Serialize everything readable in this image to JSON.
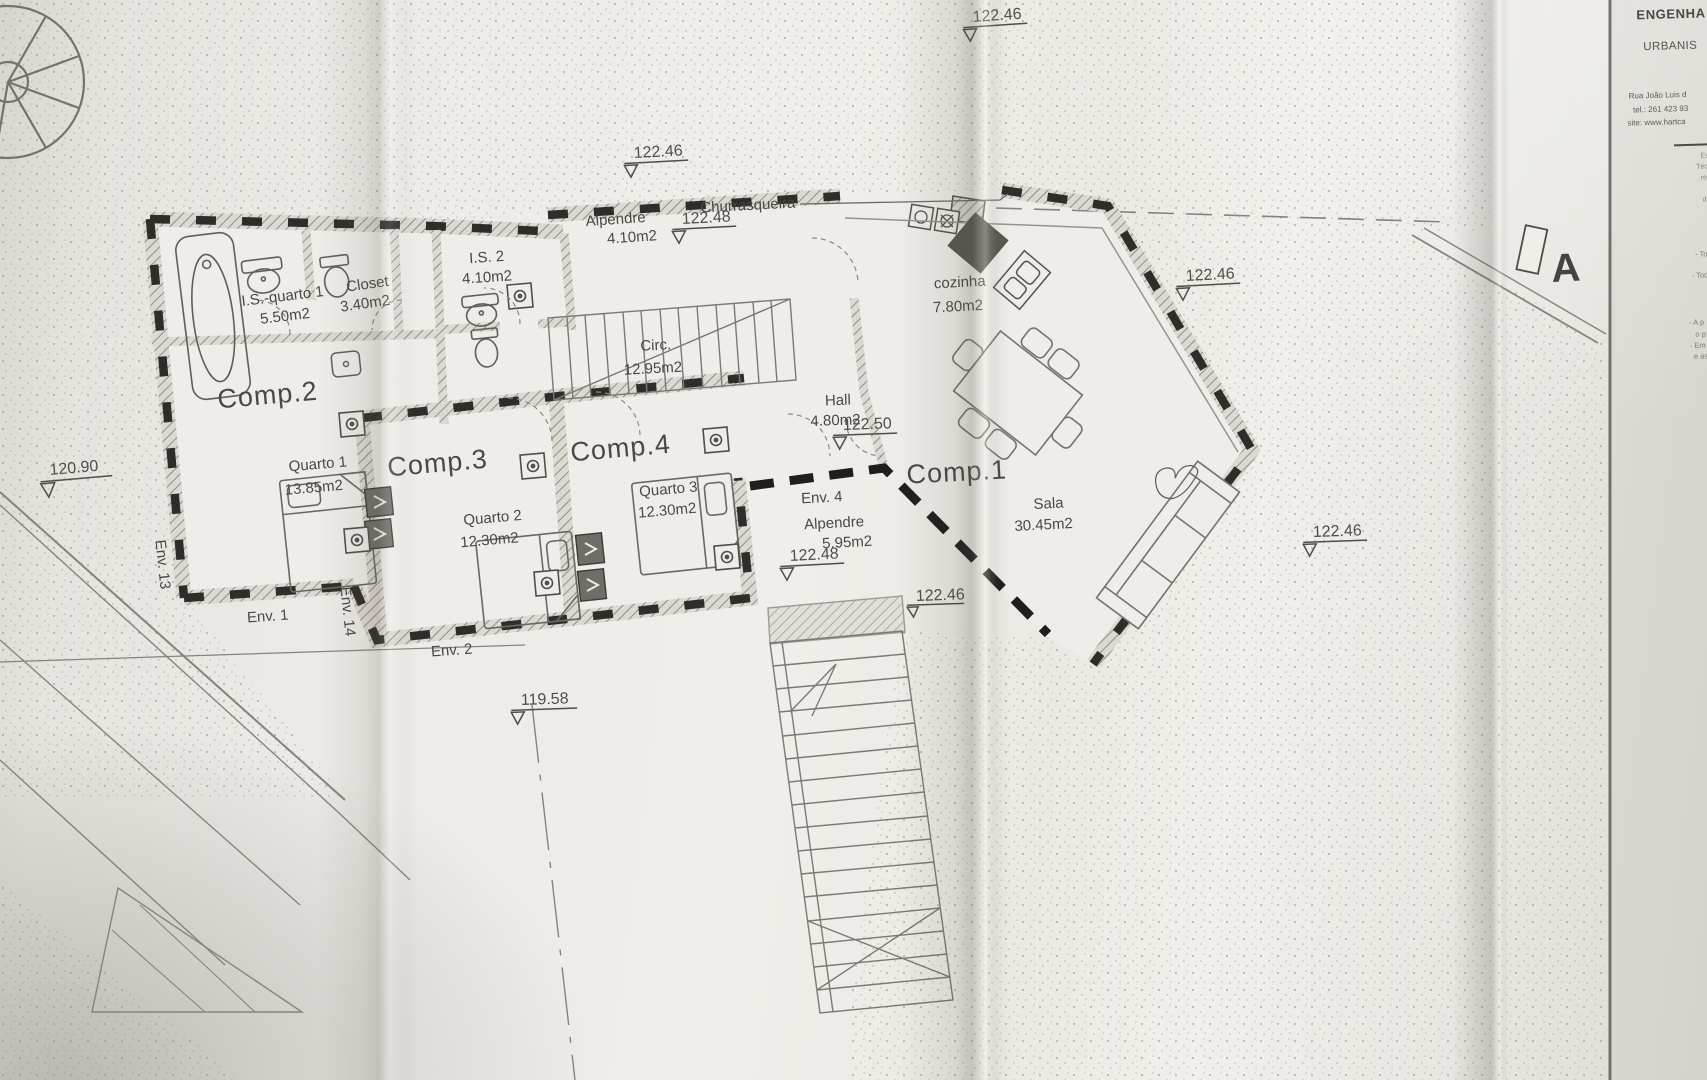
{
  "document": {
    "type": "floor-plan-photo",
    "section_marker": "A",
    "ink_color": "#45433f",
    "paper_color": "#efede9"
  },
  "title_block": {
    "heading1": "ENGENHA",
    "heading2": "URBANIS",
    "address_line": "Rua João Luis d",
    "tel_line": "tel.: 261 423 93",
    "site_line": "site: www.hartca",
    "fine_print": [
      "Este d",
      "Técnico",
      "reprod",
      "sem",
      "direito"
    ],
    "notes": [
      "- Tod",
      "- Toda",
      "- A p",
      "o p",
      "- Em",
      "e as"
    ]
  },
  "rooms": {
    "comp1": {
      "label": "Comp.1",
      "name": "Sala",
      "area": "30.45m2"
    },
    "comp2": {
      "label": "Comp.2",
      "name": "Quarto 1",
      "area": "13.85m2"
    },
    "comp3": {
      "label": "Comp.3",
      "name": "Quarto 2",
      "area": "12.30m2"
    },
    "comp4": {
      "label": "Comp.4",
      "name": "Quarto 3",
      "area": "12.30m2"
    },
    "is_quarto1": {
      "name": "I.S.-quarto 1",
      "area": "5.50m2"
    },
    "closet": {
      "name": "Closet",
      "area": "3.40m2"
    },
    "is2": {
      "name": "I.S. 2",
      "area": "4.10m2"
    },
    "alpendre_norte": {
      "name": "Alpendre",
      "area": "4.10m2"
    },
    "churrasqueira": {
      "name": "Churrasqueira"
    },
    "cozinha": {
      "name": "cozinha",
      "area": "7.80m2"
    },
    "circ": {
      "name": "Circ.",
      "area": "12.95m2"
    },
    "hall": {
      "name": "Hall",
      "area": "4.80m2"
    },
    "env4_alpendre": {
      "label": "Env. 4",
      "name": "Alpendre",
      "area": "5.95m2"
    }
  },
  "envelopes": {
    "env1": "Env. 1",
    "env2": "Env. 2",
    "env13": "Env. 13",
    "env14": "Env. 14"
  },
  "levels": [
    "122.46",
    "122.46",
    "122.48",
    "122.46",
    "122.50",
    "122.48",
    "122.46",
    "122.46",
    "120.90",
    "119.58"
  ]
}
